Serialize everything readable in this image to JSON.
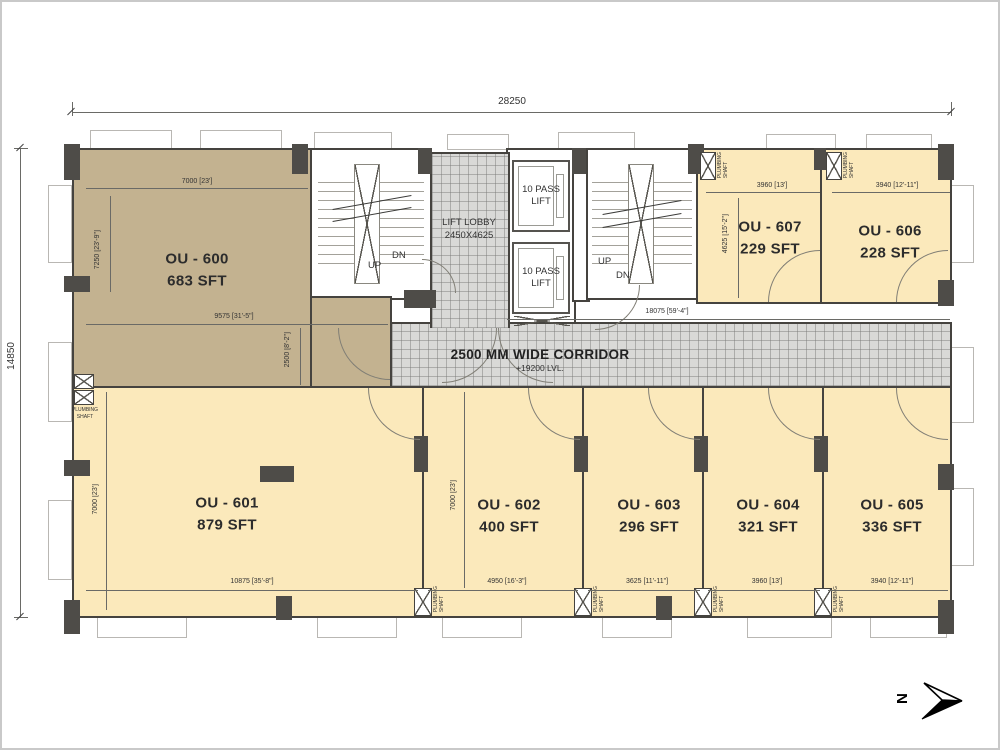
{
  "plan": {
    "overall_width_dim": "28250",
    "overall_height_dim": "14850",
    "corridor": {
      "title": "2500 MM WIDE CORRIDOR",
      "level": "+19200  LVL.",
      "dim": "18075 [59'-4\"]"
    },
    "core": {
      "lift_lobby_line1": "LIFT LOBBY",
      "lift_lobby_line2": "2450X4625",
      "lift_label": "10 PASS LIFT",
      "up": "UP",
      "dn": "DN"
    },
    "shaft": {
      "line1": "PLUMBING",
      "line2": "SHAFT"
    },
    "north_label": "N",
    "rooms": [
      {
        "name": "OU - 600",
        "area": "683 SFT",
        "dim_top": "7000 [23']",
        "dim_side": "7250 [23'-9\"]",
        "dim_bottom": "9575 [31'-5\"]",
        "dim_strip": "2500 [8'-2\"]"
      },
      {
        "name": "OU - 601",
        "area": "879 SFT",
        "dim_bottom": "10875 [35'-8\"]",
        "dim_side": "7000 [23']"
      },
      {
        "name": "OU - 602",
        "area": "400 SFT",
        "dim_bottom": "4950 [16'-3\"]",
        "dim_side": "7000 [23']"
      },
      {
        "name": "OU - 603",
        "area": "296 SFT",
        "dim_bottom": "3625 [11'-11\"]"
      },
      {
        "name": "OU - 604",
        "area": "321 SFT",
        "dim_bottom": "3960 [13']"
      },
      {
        "name": "OU - 605",
        "area": "336 SFT",
        "dim_bottom": "3940 [12'-11\"]"
      },
      {
        "name": "OU - 606",
        "area": "228 SFT",
        "dim_top": "3940 [12'-11\"]"
      },
      {
        "name": "OU - 607",
        "area": "229 SFT",
        "dim_top": "3960 [13']",
        "dim_side": "4625 [15'-2\"]"
      }
    ],
    "colors": {
      "room_fill": "#fbe9bb",
      "ou600_fill": "#c3b290",
      "corridor_fill": "#d9d9d7",
      "wall": "#45433f"
    }
  }
}
